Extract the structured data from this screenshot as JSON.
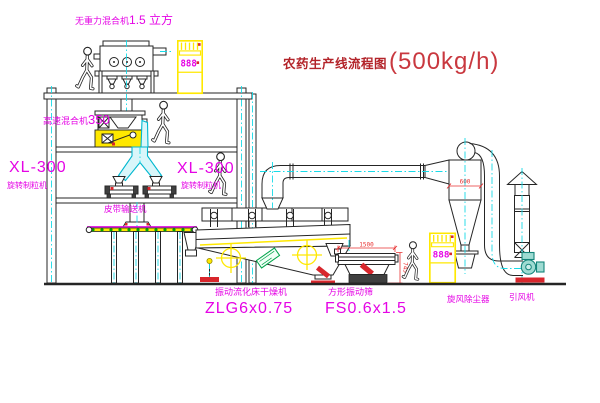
{
  "title": {
    "name": "农药生产线流程图",
    "capacity": "(500kg/h)"
  },
  "equipment": {
    "gravity_mixer": {
      "name": "无重力混合机",
      "capacity": "1.5 立方"
    },
    "high_speed_mixer": {
      "name": "高速混合机",
      "capacity": "350"
    },
    "granulator_left": {
      "model": "XL-300",
      "name": "旋转制粒机"
    },
    "granulator_right": {
      "model": "XL-300",
      "name": "旋转制粒机"
    },
    "belt_conveyor": {
      "name": "皮带输送机"
    },
    "fluid_bed_dryer": {
      "name": "振动流化床干燥机",
      "model": "ZLG6x0.75"
    },
    "vibrating_screen": {
      "name": "方形振动筛",
      "model": "FS0.6x1.5"
    },
    "cyclone": {
      "name": "旋风除尘器"
    },
    "induced_draft_fan": {
      "name": "引风机"
    }
  },
  "dimensions": {
    "screen_length": "1500",
    "screen_height": "745",
    "cyclone_diameter": "600"
  },
  "control_cabinet": {
    "display": "888"
  },
  "colors": {
    "label": "#e504e5",
    "title": "#b3242a",
    "highlight": "#ffe800",
    "centerline": "#18dbe8",
    "dimension": "#e83030",
    "status_green": "#00a400"
  }
}
